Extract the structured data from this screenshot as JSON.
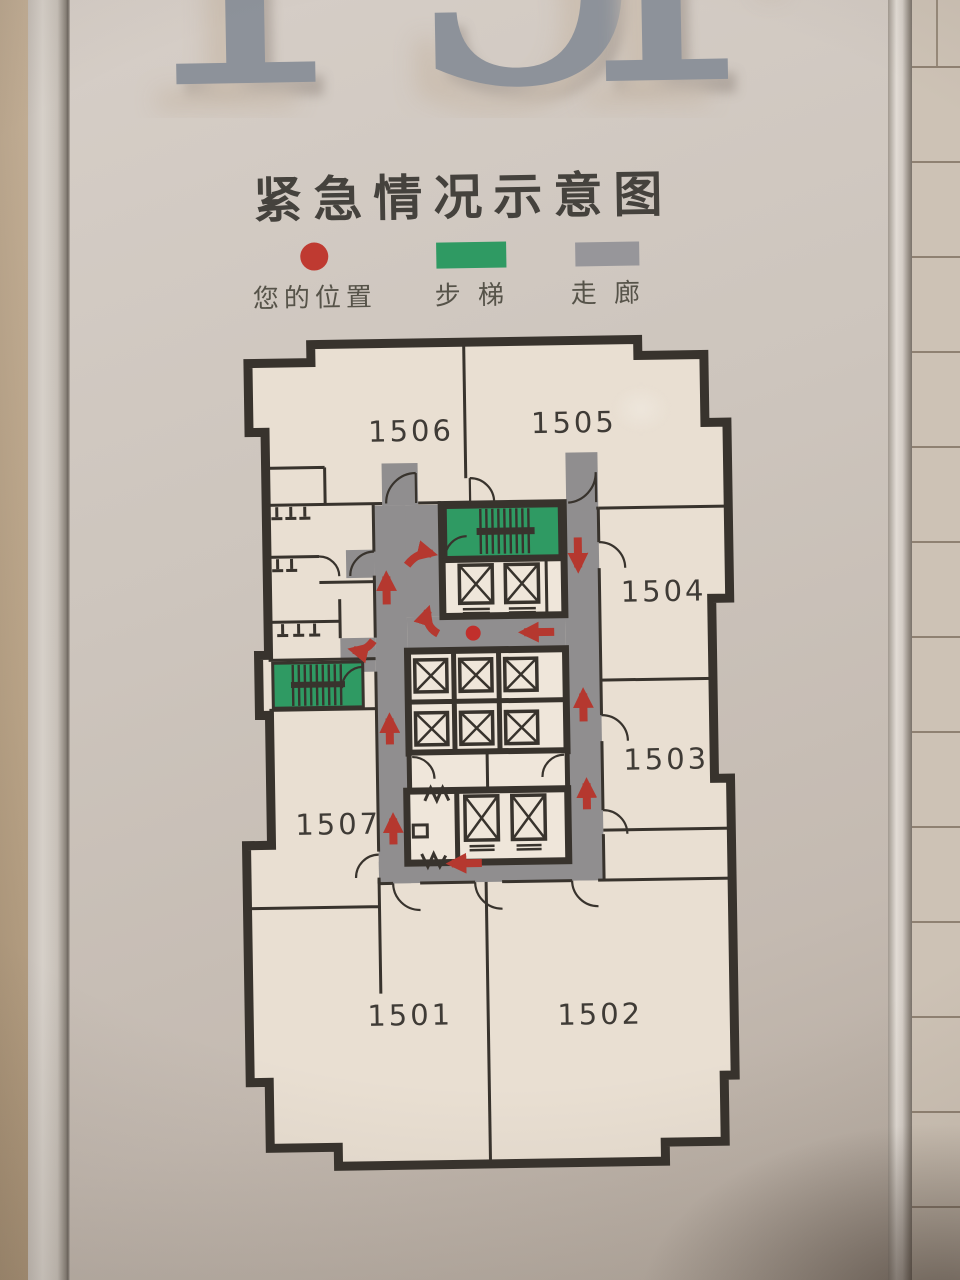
{
  "sign": {
    "floor_label": "15F",
    "floor_chars": {
      "d1": "1",
      "d2": "5",
      "d3": "F"
    },
    "title": "紧急情况示意图",
    "legend": {
      "location": {
        "label": "您的位置",
        "color": "#bf3a31",
        "symbol": "dot"
      },
      "stairs": {
        "label": "步 梯",
        "color": "#2f9a63",
        "symbol": "rect"
      },
      "corridor": {
        "label": "走 廊",
        "color": "#97969a",
        "symbol": "rect"
      }
    },
    "rooms": {
      "r1506": "1506",
      "r1505": "1505",
      "r1504": "1504",
      "r1503": "1503",
      "r1507": "1507",
      "r1501": "1501",
      "r1502": "1502"
    },
    "colors": {
      "wall": "#38332d",
      "room_fill": "#e9dfd2",
      "corridor": "#908e8f",
      "stair_green": "#2f9a63",
      "arrow_red": "#b5382f",
      "panel": "#cdc5bd"
    }
  }
}
